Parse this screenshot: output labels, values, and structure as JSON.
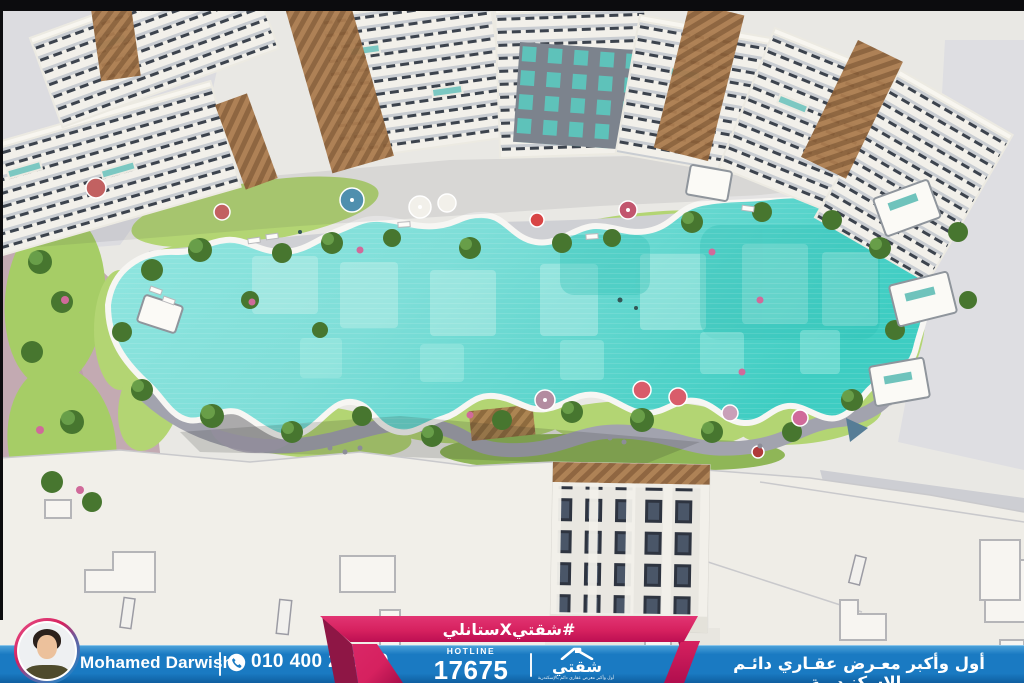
{
  "theme": {
    "accent_pink": "#d6215f",
    "accent_pink_dark": "#8e1645",
    "bar_blue": "#1a7ac2",
    "bar_blue_dark": "#0e5c9c",
    "bar_blue_light": "#4aa0d8",
    "pool_turquoise": "#7eded8",
    "pool_turquoise_deep": "#3ecdc2",
    "lawn_green": "#b3d573",
    "foliage_green": "#47762f",
    "pavement_gray": "#d9d9db",
    "rooftop_white": "#f1efe9"
  },
  "ribbon": {
    "hashtag": "#شقتيXستانلي"
  },
  "agent": {
    "name": "Mohamed Darwish",
    "phone": "010 400 270 59"
  },
  "hotline": {
    "label": "HOTLINE",
    "number": "17675"
  },
  "brand": {
    "logo_text": "شقتي",
    "logo_tagline": "أول وأكبر معرض عقاري دائم بالإسكندرية"
  },
  "banner": {
    "tagline": "أول وأكبر معـرض عقـاري دائـم بالإسكنـدرية"
  },
  "icons": {
    "phone": "phone-icon",
    "house": "house-roof-icon"
  },
  "scene": {
    "description": "aerial view of residential compound with lagoon swimming pool, gardens, palm trees, umbrellas and white apartment buildings"
  }
}
